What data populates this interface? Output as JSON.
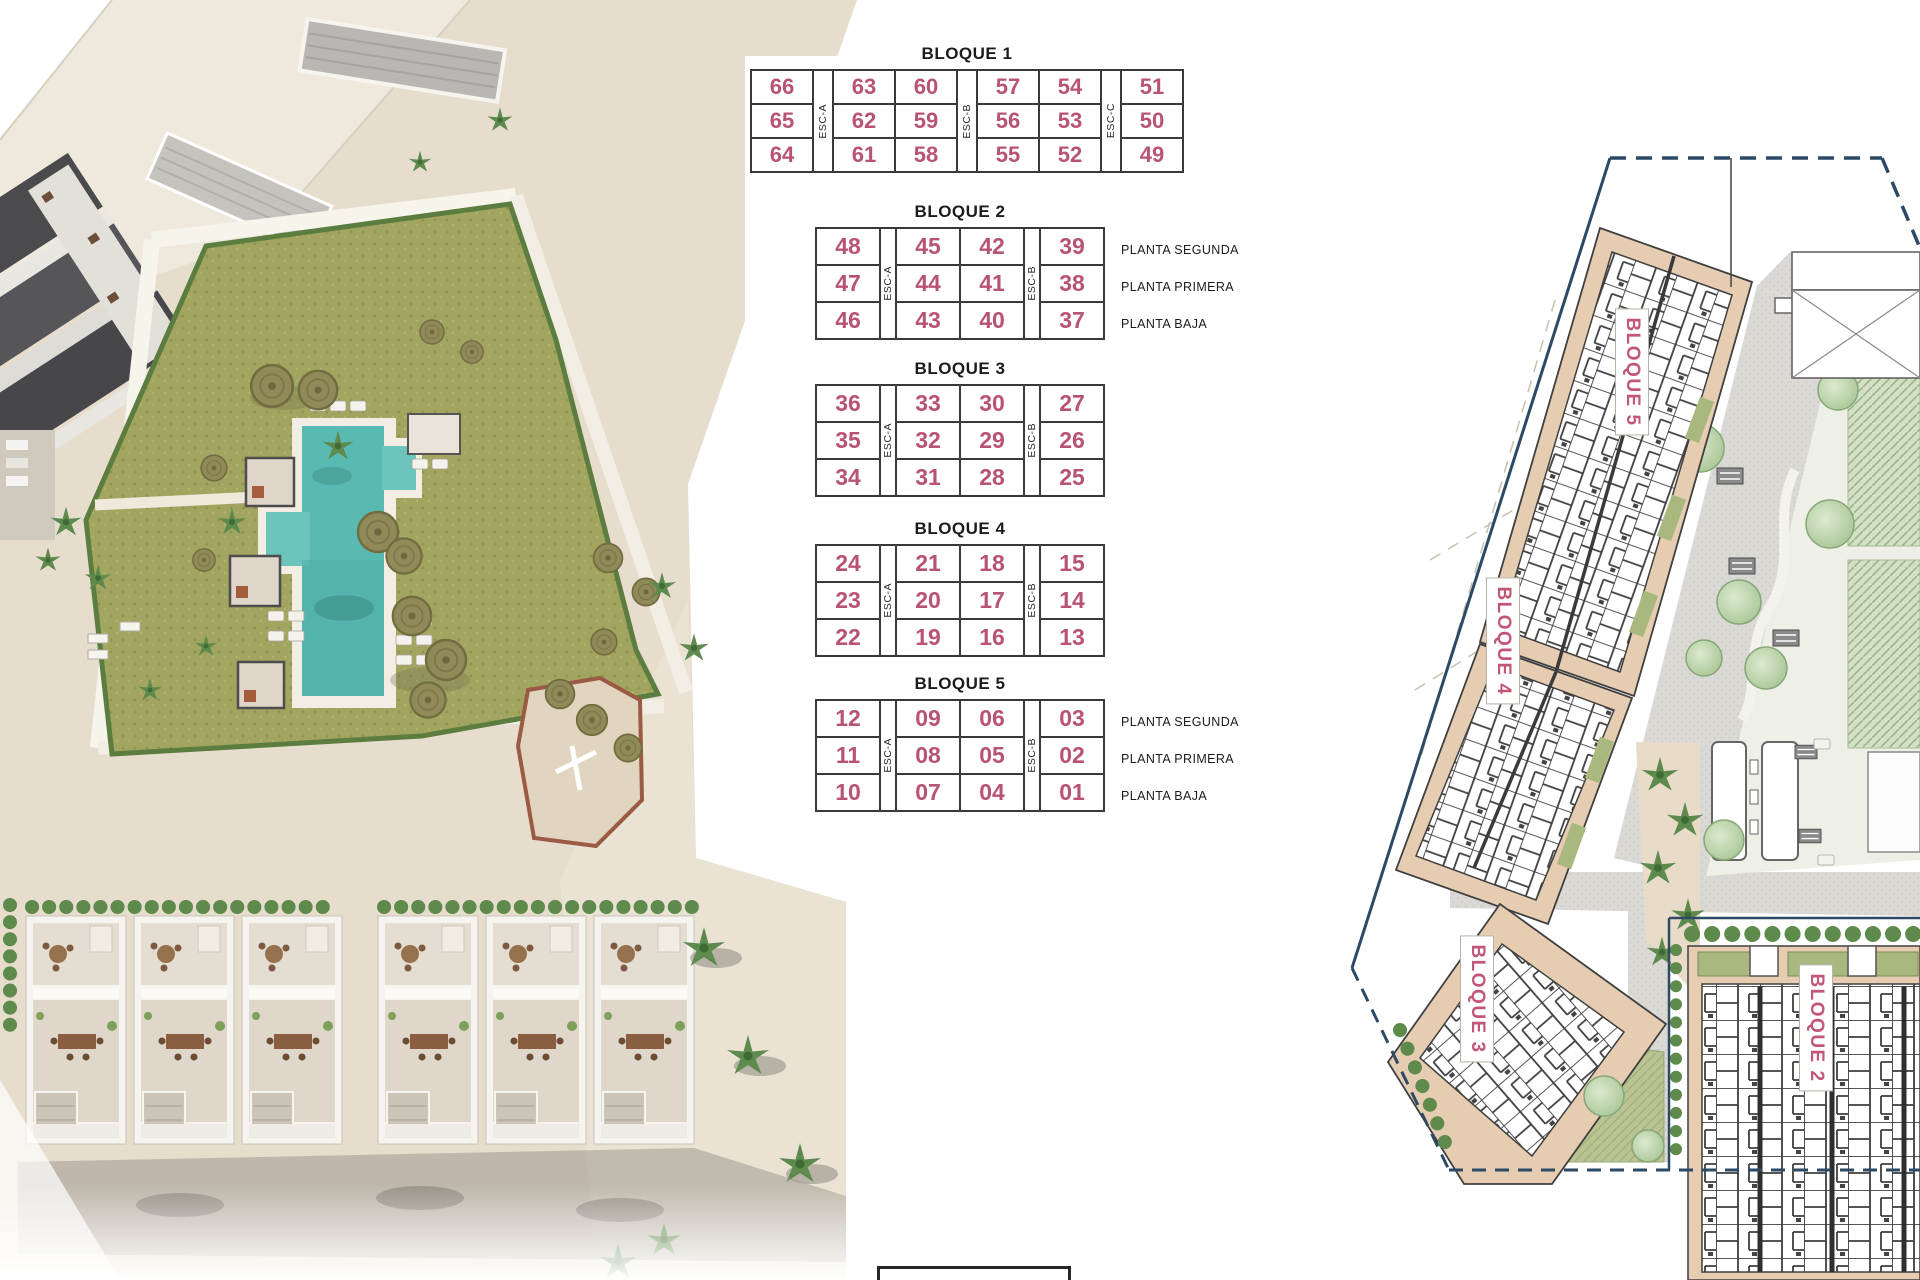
{
  "document": {
    "kind": "residential development site plan with unit number key tables",
    "language": "es"
  },
  "palette": {
    "unit_number_pink": "#b95374",
    "plan_label_pink": "#c25677",
    "boundary_navy": "#2c4a66",
    "building_tan": "#e6cdb2",
    "pool_teal": "#59bab4",
    "lawn_olive": "#a2a55f",
    "garden_green": "#b9d4a8",
    "paving_gray": "#dbd9d5"
  },
  "unit_tables": [
    {
      "id": "bloque-1",
      "title": "BLOQUE 1",
      "left": 750,
      "top": 72,
      "unit_w": 60,
      "esc_w": 18,
      "row_h": 32,
      "num_size": 22,
      "esc_labels": [
        "ESC-A",
        "ESC-B",
        "ESC-C"
      ],
      "esc_after": [
        0,
        2,
        4
      ],
      "rows": [
        [
          "66",
          "63",
          "60",
          "57",
          "54",
          "51"
        ],
        [
          "65",
          "62",
          "59",
          "56",
          "53",
          "50"
        ],
        [
          "64",
          "61",
          "58",
          "55",
          "52",
          "49"
        ]
      ],
      "planta_labels": []
    },
    {
      "id": "bloque-2",
      "title": "BLOQUE 2",
      "left": 815,
      "top": 230,
      "unit_w": 62,
      "esc_w": 14,
      "row_h": 35,
      "num_size": 23,
      "esc_labels": [
        "ESC-A",
        "ESC-B"
      ],
      "esc_after": [
        0,
        2
      ],
      "rows": [
        [
          "48",
          "45",
          "42",
          "39"
        ],
        [
          "47",
          "44",
          "41",
          "38"
        ],
        [
          "46",
          "43",
          "40",
          "37"
        ]
      ],
      "planta_labels": [
        "PLANTA SEGUNDA",
        "PLANTA PRIMERA",
        "PLANTA BAJA"
      ]
    },
    {
      "id": "bloque-3",
      "title": "BLOQUE 3",
      "left": 815,
      "top": 387,
      "unit_w": 62,
      "esc_w": 14,
      "row_h": 35,
      "num_size": 23,
      "esc_labels": [
        "ESC-A",
        "ESC-B"
      ],
      "esc_after": [
        0,
        2
      ],
      "rows": [
        [
          "36",
          "33",
          "30",
          "27"
        ],
        [
          "35",
          "32",
          "29",
          "26"
        ],
        [
          "34",
          "31",
          "28",
          "25"
        ]
      ],
      "planta_labels": []
    },
    {
      "id": "bloque-4",
      "title": "BLOQUE 4",
      "left": 815,
      "top": 547,
      "unit_w": 62,
      "esc_w": 14,
      "row_h": 35,
      "num_size": 23,
      "esc_labels": [
        "ESC-A",
        "ESC-B"
      ],
      "esc_after": [
        0,
        2
      ],
      "rows": [
        [
          "24",
          "21",
          "18",
          "15"
        ],
        [
          "23",
          "20",
          "17",
          "14"
        ],
        [
          "22",
          "19",
          "16",
          "13"
        ]
      ],
      "planta_labels": []
    },
    {
      "id": "bloque-5",
      "title": "BLOQUE 5",
      "left": 815,
      "top": 702,
      "unit_w": 62,
      "esc_w": 14,
      "row_h": 35,
      "num_size": 23,
      "esc_labels": [
        "ESC-A",
        "ESC-B"
      ],
      "esc_after": [
        0,
        2
      ],
      "rows": [
        [
          "12",
          "09",
          "06",
          "03"
        ],
        [
          "11",
          "08",
          "05",
          "02"
        ],
        [
          "10",
          "07",
          "04",
          "01"
        ]
      ],
      "planta_labels": [
        "PLANTA SEGUNDA",
        "PLANTA PRIMERA",
        "PLANTA BAJA"
      ]
    }
  ],
  "plan_labels": [
    {
      "id": "bloque-5",
      "text": "BLOQUE 5",
      "x": 1632,
      "y": 372
    },
    {
      "id": "bloque-4",
      "text": "BLOQUE 4",
      "x": 1503,
      "y": 641
    },
    {
      "id": "bloque-3",
      "text": "BLOQUE 3",
      "x": 1477,
      "y": 999
    },
    {
      "id": "bloque-2",
      "text": "BLOQUE 2",
      "x": 1816,
      "y": 1028
    }
  ]
}
